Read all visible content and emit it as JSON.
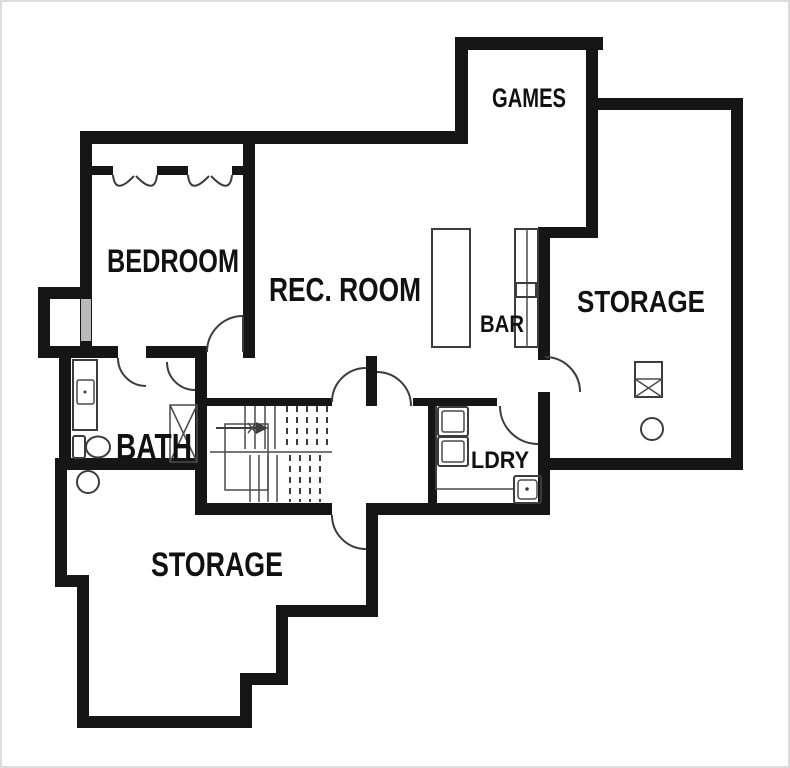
{
  "title": "Basement floor plan",
  "rooms": {
    "games": {
      "label": "GAMES"
    },
    "bedroom": {
      "label": "BEDROOM"
    },
    "rec_room": {
      "label": "REC. ROOM"
    },
    "bar": {
      "label": "BAR"
    },
    "storage_right": {
      "label": "STORAGE"
    },
    "bath": {
      "label": "BATH"
    },
    "laundry": {
      "label": "LDRY"
    },
    "storage_lower": {
      "label": "STORAGE"
    }
  },
  "fixtures": [
    "bifold-closet-doors",
    "window",
    "vanity-sink",
    "toilet",
    "floor-drain",
    "linen-closet-x",
    "u-stairs-with-up-arrow",
    "kitchen-island",
    "bar-counter",
    "bar-sink",
    "washer-dryer-stack",
    "utility-sink",
    "furnace",
    "water-heater",
    "door-swings"
  ],
  "colors": {
    "wall": "#161616",
    "line": "#3c3c3c",
    "window": "#b9b9b9",
    "background": "#ffffff",
    "label": "#111111",
    "frame": "#dcdcdc"
  }
}
